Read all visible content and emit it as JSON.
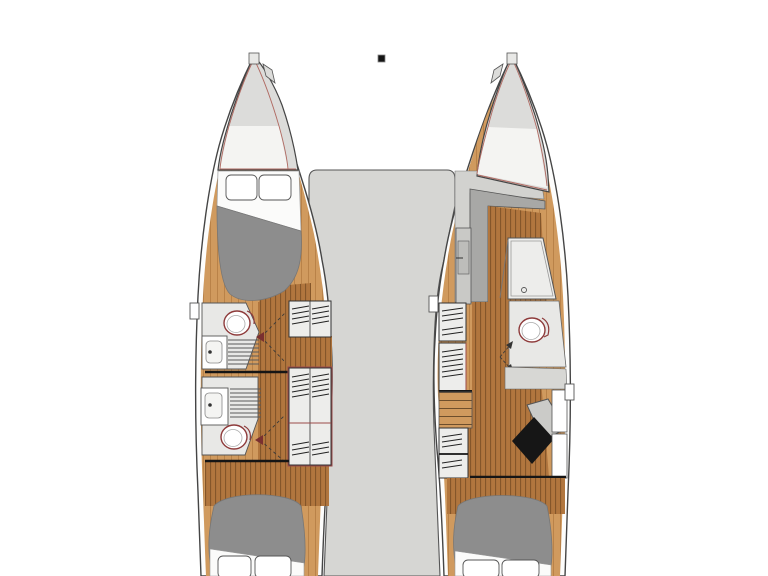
{
  "diagram": {
    "type": "catamaran-deck-plan",
    "view": "top-down interior layout, two hulls with center bridgedeck",
    "visible_text": [],
    "components": [
      {
        "name": "mast-base-marker",
        "shape": "small black square at top center"
      },
      {
        "name": "port-bow",
        "shape": "pointed bow with anchor-locker lines"
      },
      {
        "name": "starboard-bow",
        "shape": "pointed bow with anchor-locker lines"
      },
      {
        "name": "bridgedeck",
        "shape": "gray center deck between hulls"
      },
      {
        "name": "port-hull",
        "rooms": [
          "forward-berth",
          "forward-head",
          "aft-head",
          "aft-berth"
        ]
      },
      {
        "name": "starboard-hull",
        "rooms": [
          "forward-shower",
          "head",
          "desk-area",
          "aft-berth"
        ]
      },
      {
        "name": "port-forward-berth",
        "items": [
          "two-pillows",
          "sheet",
          "gray-mattress"
        ]
      },
      {
        "name": "port-forward-head",
        "items": [
          "toilet",
          "sink",
          "shower-grate",
          "door-swing"
        ]
      },
      {
        "name": "port-aft-head",
        "items": [
          "toilet",
          "sink",
          "shower-grate",
          "door-swing"
        ]
      },
      {
        "name": "port-inboard-cabinets",
        "items": [
          "hatched-locker-small",
          "hatched-locker-large"
        ]
      },
      {
        "name": "port-aft-berth",
        "items": [
          "gray-mattress",
          "sheet",
          "two-pillows"
        ]
      },
      {
        "name": "starboard-entry-steps",
        "shape": "gray companionway bands"
      },
      {
        "name": "starboard-shower-stall",
        "items": [
          "glass-door",
          "drain"
        ]
      },
      {
        "name": "starboard-head",
        "items": [
          "toilet",
          "door-swing"
        ]
      },
      {
        "name": "starboard-desk",
        "items": [
          "desk-top",
          "black-chair"
        ]
      },
      {
        "name": "starboard-inboard-cabinets",
        "items": [
          "hatched-locker",
          "hatched-locker",
          "steps",
          "hatched-locker"
        ]
      },
      {
        "name": "starboard-aft-berth",
        "items": [
          "gray-mattress",
          "sheet",
          "two-pillows"
        ]
      }
    ]
  },
  "palette": {
    "background": "#ffffff",
    "deck": "#d6d6d3",
    "bow": "#dcdcda",
    "hull_fill": "#fdfdfc",
    "outline": "#454545",
    "line_soft": "#555555",
    "line_faint": "#999999",
    "wood_floor": "#b1763e",
    "wood_floor_line": "#7f5227",
    "wood_side": "#d09a5e",
    "wood_side_line": "#b77f45",
    "step_line": "#6d4e2c",
    "mattress": "#8d8d8d",
    "pillow": "#ffffff",
    "sheet": "#fbfbfa",
    "room": "#e8e8e6",
    "cabinet": "#ededeb",
    "step_gray": "#a8a8a6",
    "entry_light": "#d2d2cf",
    "wall_band": "#d7d7d4",
    "panel_gray": "#c9c9c6",
    "accent_red": "#b06a62",
    "toilet_red": "#8e3b3b",
    "cabinet_red": "#9a4a4a",
    "hatch": "#222222",
    "chair_black": "#161616",
    "bulkhead_black": "#151515",
    "desk_gray": "#cbcbc8",
    "mast_black": "#141414",
    "near_white": "#f4f4f2"
  }
}
